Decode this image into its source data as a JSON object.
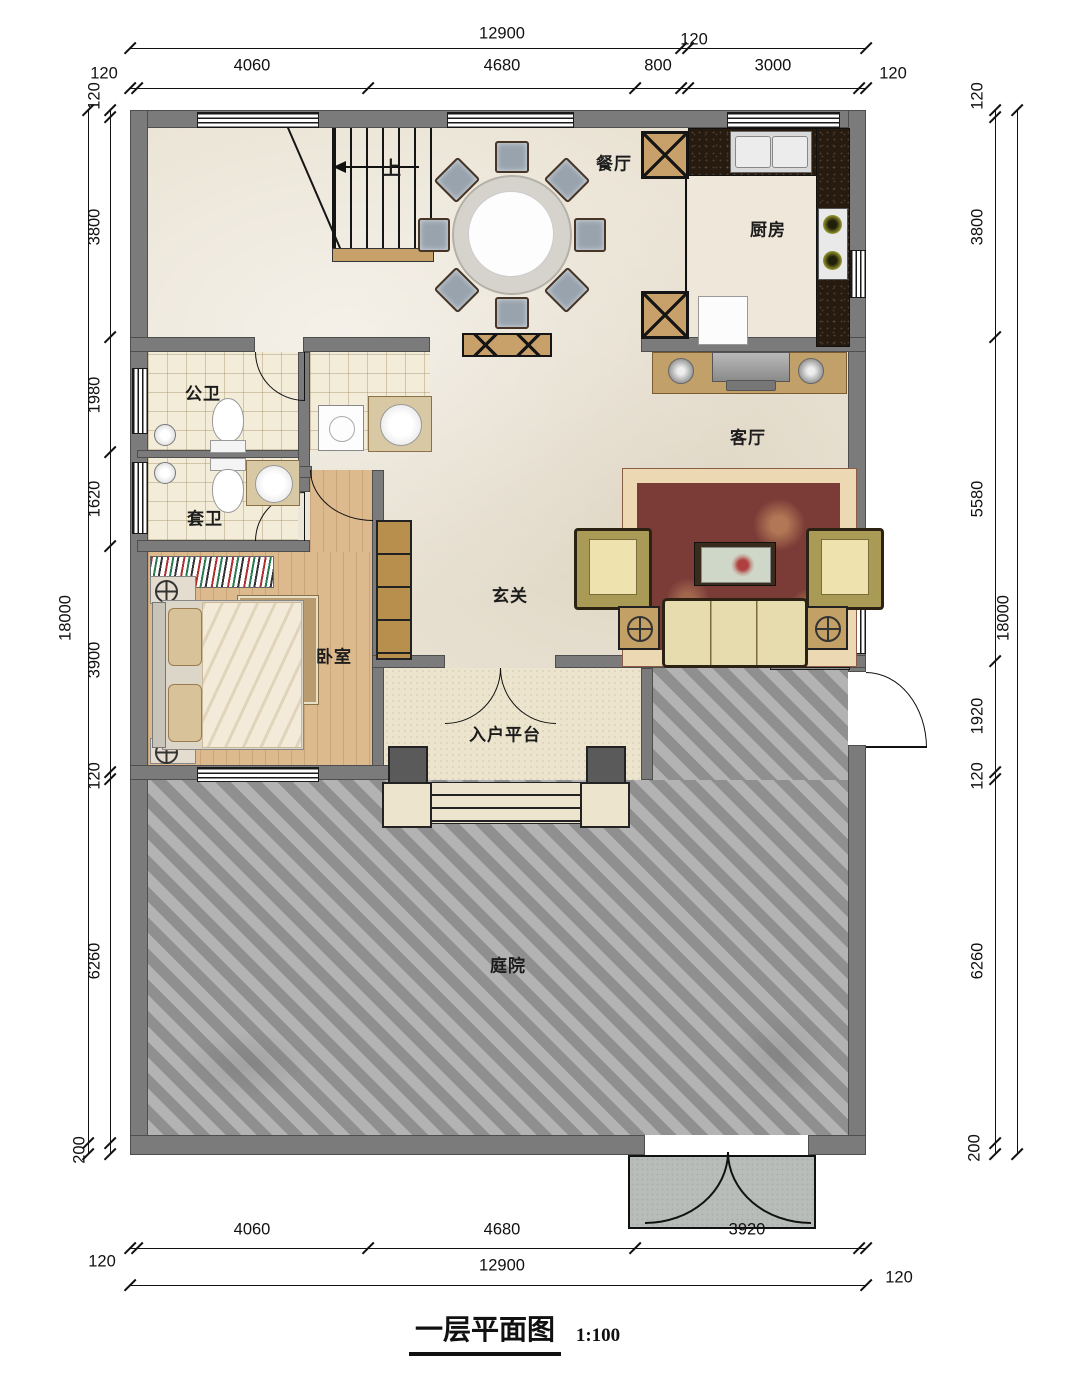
{
  "title": {
    "text": "一层平面图",
    "scale": "1:100"
  },
  "rooms": {
    "dining": "餐厅",
    "kitchen": "厨房",
    "living": "客厅",
    "public_bath": "公卫",
    "ensuite_bath": "套卫",
    "bedroom": "卧室",
    "foyer": "玄关",
    "entry_platform": "入户平台",
    "courtyard": "庭院",
    "stair_up": "上"
  },
  "dimensions": {
    "top": {
      "overall": "12900",
      "segments": [
        "120",
        "4060",
        "4680",
        "800",
        "120",
        "3000",
        "120"
      ]
    },
    "bottom": {
      "overall": "12900",
      "segments": [
        "120",
        "4060",
        "4680",
        "3920",
        "120"
      ]
    },
    "left": {
      "overall": "18000",
      "segments": [
        "120",
        "3800",
        "1980",
        "1620",
        "3900",
        "120",
        "6260",
        "200"
      ]
    },
    "right": {
      "overall": "18000",
      "segments": [
        "120",
        "3800",
        "5580",
        "1920",
        "120",
        "6260",
        "200"
      ]
    }
  },
  "colors": {
    "wall": "#7b7b7b",
    "marble_floor": "#eae3d4",
    "wood_floor": "#dcba8e",
    "tile_floor": "#f2ecd9",
    "courtyard_paving": "#a3a3a3",
    "dark_counter": "#271a0f",
    "furniture_tan": "#c8a06a",
    "rug_center": "#7b3c38",
    "rug_border": "#ecd9b4"
  }
}
